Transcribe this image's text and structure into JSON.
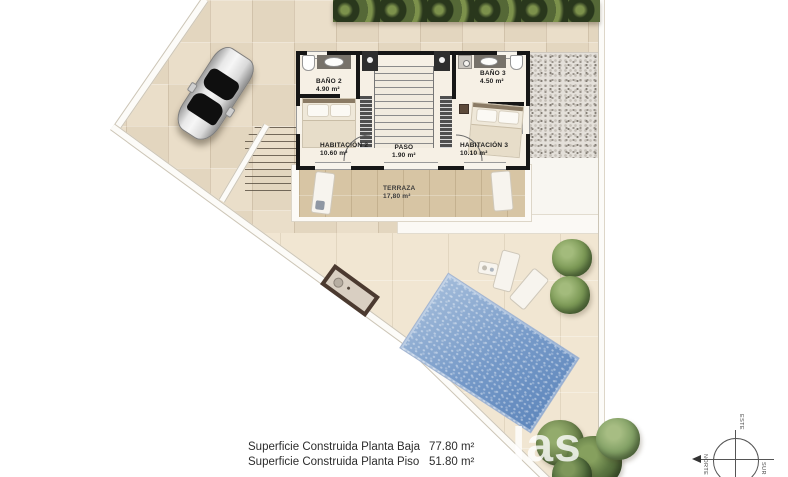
{
  "plan": {
    "type": "floor-plan",
    "rooms": {
      "bano2": {
        "name": "BAÑO 2",
        "area": "4.90 m²"
      },
      "bano3": {
        "name": "BAÑO 3",
        "area": "4.50 m²"
      },
      "habitacion2": {
        "name": "HABITACIÓN 2",
        "area": "10.60 m²"
      },
      "paso": {
        "name": "PASO",
        "area": "1.90 m²"
      },
      "habitacion3": {
        "name": "HABITACIÓN 3",
        "area": "10.10 m²"
      },
      "terraza": {
        "name": "TERRAZA",
        "area": "17,80 m²"
      }
    }
  },
  "summary": {
    "rows": [
      {
        "label": "Superficie Construida Planta Baja",
        "value": "77.80 m²"
      },
      {
        "label": "Superficie Construida Planta Piso",
        "value": "51.80 m²"
      }
    ]
  },
  "compass": {
    "east": "ESTE",
    "south": "SUR",
    "north": "NORTE"
  },
  "watermark": "las",
  "colors": {
    "paving": "#e9dcc6",
    "garden": "#f1e6d2",
    "terrace": "#d7c5a4",
    "pool": "#7b9ecb",
    "hedge": "#44512f",
    "wall": "#161616"
  }
}
